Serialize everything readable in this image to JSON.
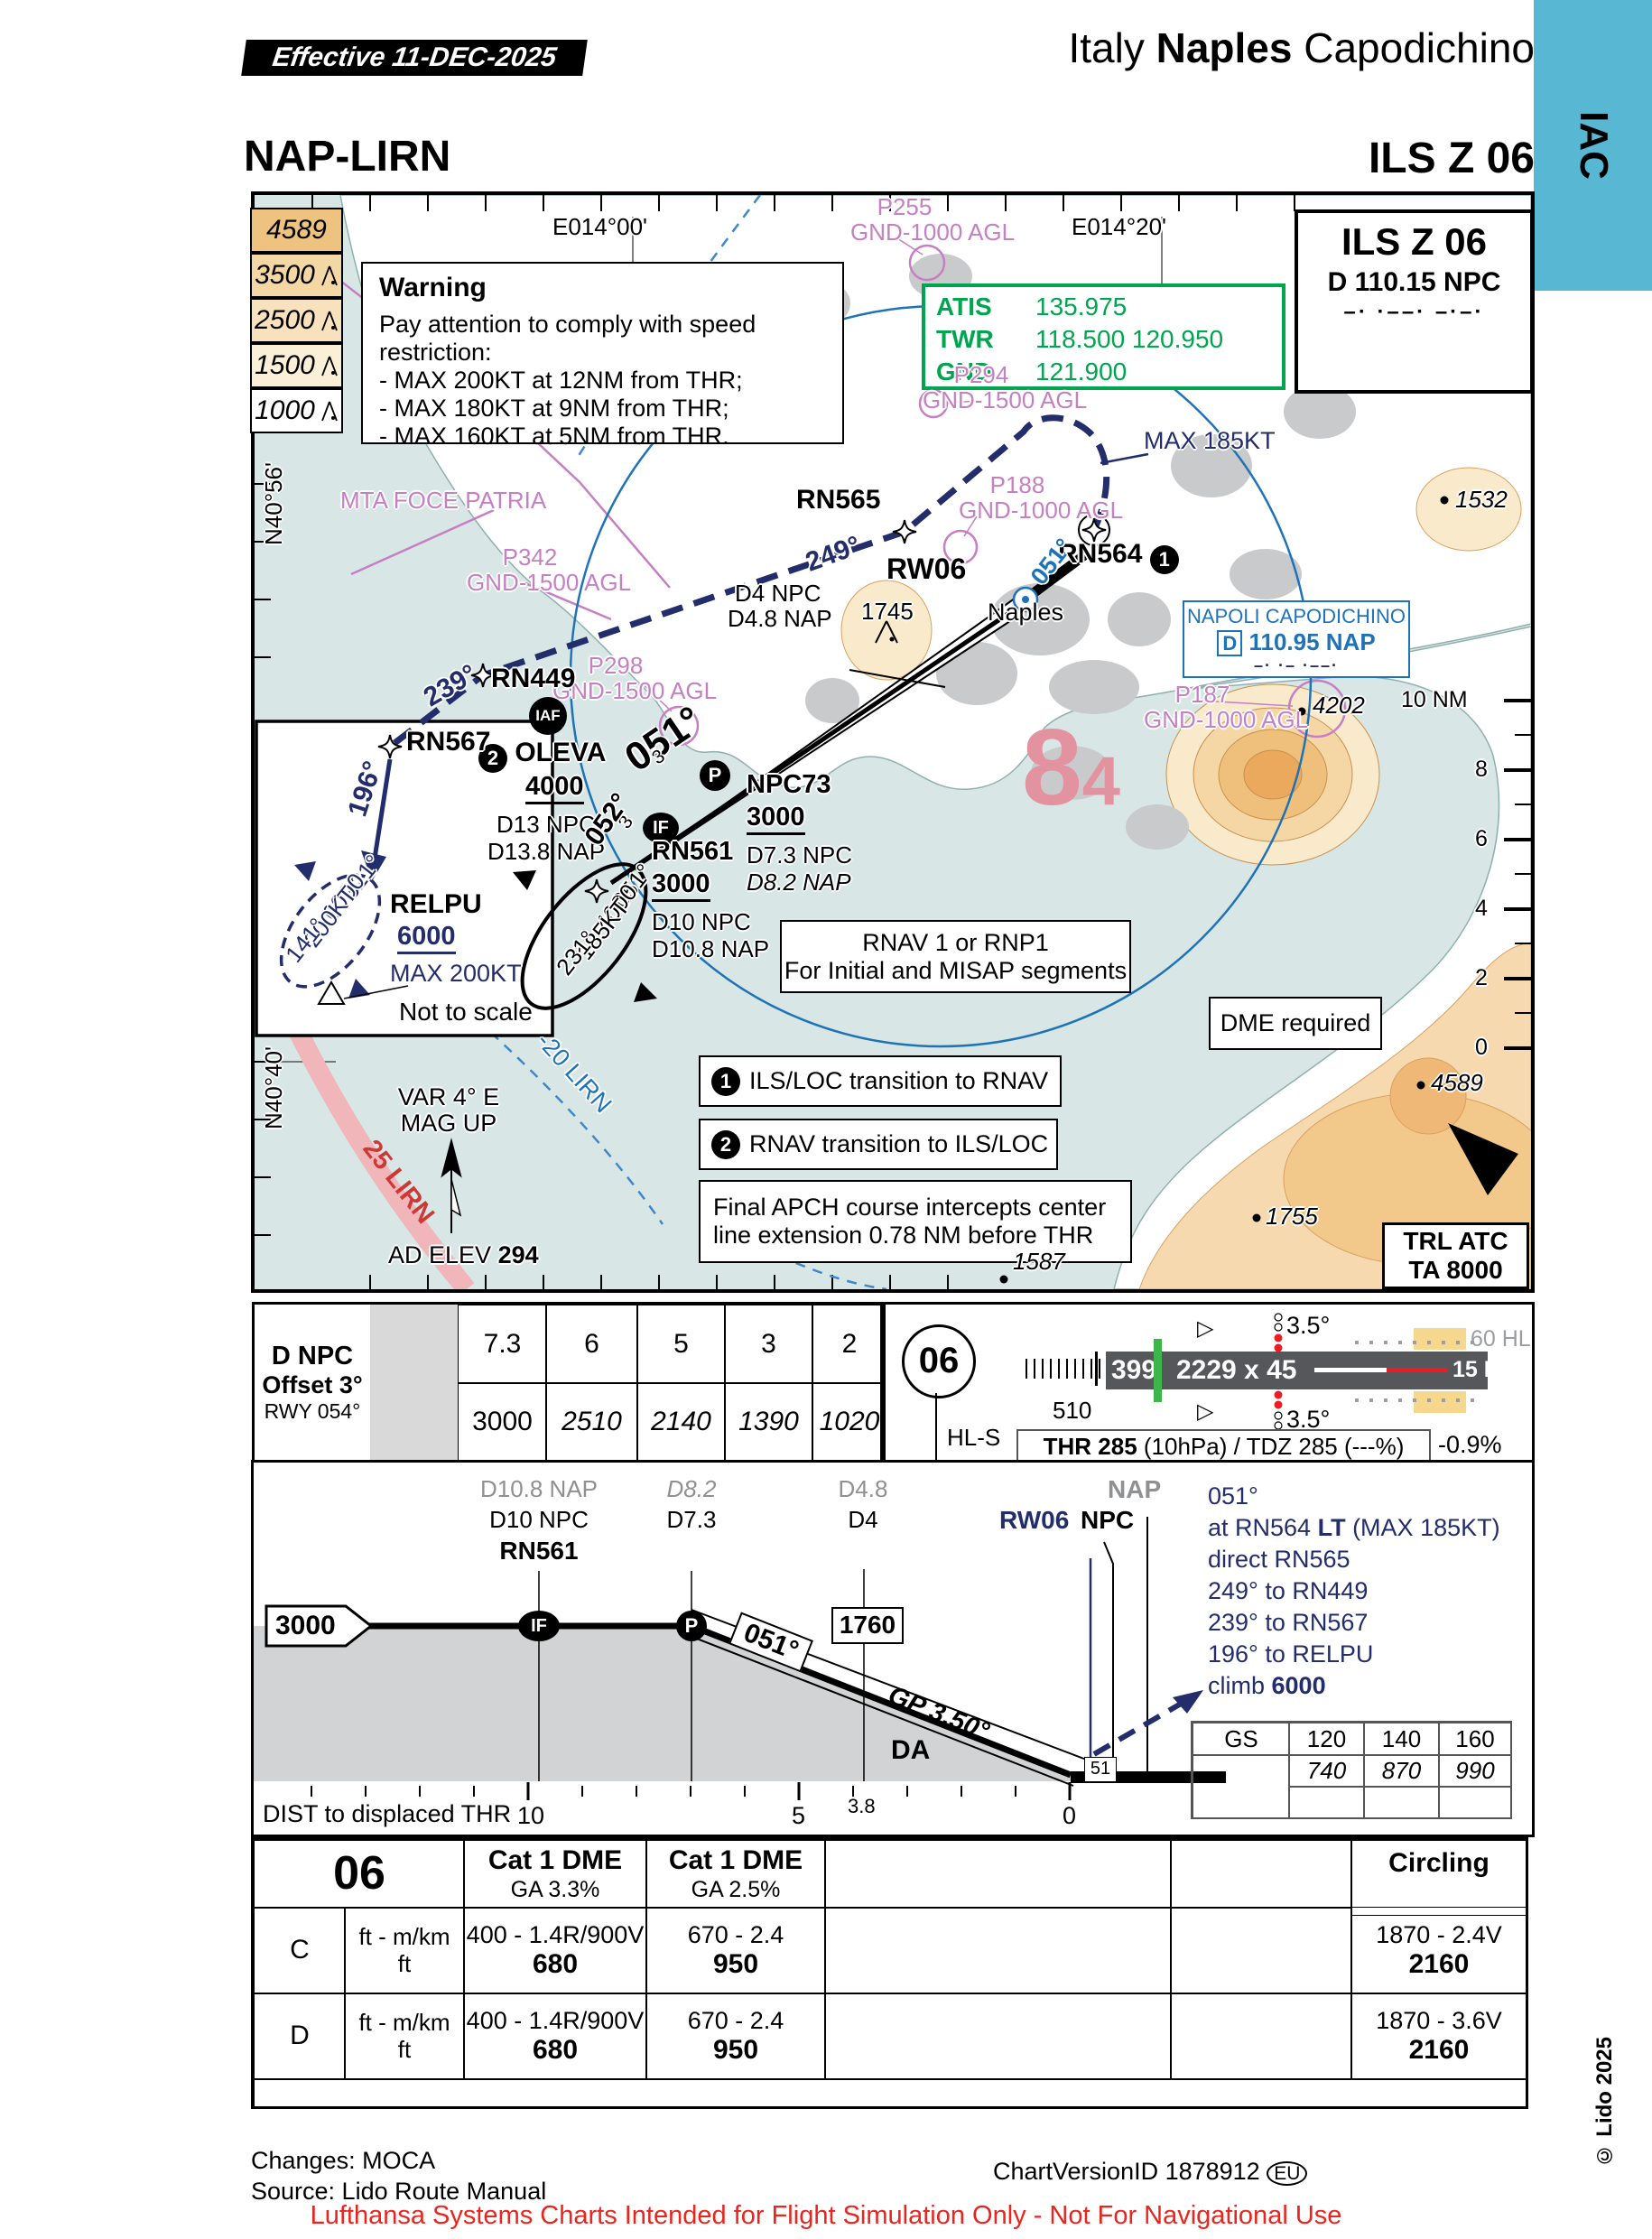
{
  "header": {
    "effective": "Effective  11-DEC-2025",
    "country": "Italy",
    "city": "Naples",
    "airport": "Capodichino",
    "tab": "IAC",
    "code": "NAP-LIRN",
    "proc": "ILS Z 06"
  },
  "ils_box": {
    "title": "ILS Z 06",
    "freq": "D 110.15 NPC",
    "morse": "–·  ·––·  –·–·"
  },
  "comms": {
    "atis_l": "ATIS",
    "atis_f": "135.975",
    "twr_l": "TWR",
    "twr_f": "118.500 120.950",
    "gnd_l": "GND",
    "gnd_f": "121.900"
  },
  "warning": {
    "title": "Warning",
    "intro": "Pay attention to comply with speed restriction:",
    "b1": "- MAX 200KT  at 12NM from THR;",
    "b2": "- MAX 180KT at 9NM from THR;",
    "b3": "- MAX 160KT at 5NM from THR."
  },
  "legend": {
    "a1": "4589",
    "a2": "3500",
    "a3": "2500",
    "a4": "1500",
    "a5": "1000"
  },
  "map": {
    "labels": {
      "e01400": "E014°00'",
      "e01420": "E014°20'",
      "p255": "P255",
      "p255g": "GND-1000 AGL",
      "p294": "P294",
      "p294g": "GND-1500 AGL",
      "mta": "MTA FOCE PATRIA",
      "p342": "P342",
      "p342g": "GND-1500 AGL",
      "rn565": "RN565",
      "c249": "249°",
      "max185": "MAX 185KT",
      "p188": "P188",
      "p188g": "GND-1000 AGL",
      "rn564": "RN564",
      "b1": "1",
      "c051blue": "051°",
      "rw06": "RW06",
      "naples": "Naples",
      "apt1": "NAPOLI CAPODICHINO",
      "aptd": "D",
      "aptf": "110.95 NAP",
      "aptm": "–· ·– ·––·",
      "e1532": "1532",
      "e1745": "1745",
      "d4npc": "D4 NPC",
      "d48nap": "D4.8 NAP",
      "p298": "P298",
      "p298g": "GND-1500 AGL",
      "p187": "P187",
      "p187g": "GND-1000 AGL",
      "e4202": "4202",
      "s10": "10 NM",
      "s8": "8",
      "s6": "6",
      "s4": "4",
      "s2": "2",
      "s0": "0",
      "c239": "239°",
      "rn449": "RN449",
      "iaf": "IAF",
      "b2": "2",
      "oleva": "OLEVA",
      "oleva_alt": "4000",
      "d13npc": "D13 NPC",
      "d138nap": "D13.8 NAP",
      "c051": "051°",
      "n3a": "3",
      "n3b": "3",
      "pbadge": "P",
      "ifbadge": "IF",
      "c052": "052°",
      "rn561": "RN561",
      "rn561alt": "3000",
      "d10npc": "D10 NPC",
      "d108nap": "D10.8 NAP",
      "npc73": "NPC73",
      "npc73alt": "3000",
      "d73npc": "D7.3 NPC",
      "d82nap": "D8.2 NAP",
      "h051": "051°",
      "h4000": "4000",
      "h185": "185KT",
      "h231": "231°",
      "big8": "8",
      "big4": "4",
      "rnav1": "RNAV 1 or RNP1",
      "rnav2": "For Initial and MISAP segments",
      "dmereq": "DME required",
      "e4589": "4589",
      "note1": "ILS/LOC transition to RNAV",
      "note2": "RNAV transition to ILS/LOC",
      "note3a": "Final APCH course intercepts center",
      "note3b": "line extension 0.78 NM before THR",
      "var1": "VAR 4° E",
      "var2": "MAG UP",
      "lirn25": "25 LIRN",
      "lirn20": "-20 LIRN",
      "adelev": "AD ELEV",
      "adelevv": "294",
      "e1755": "1755",
      "e1587": "1587",
      "trl1": "TRL ATC",
      "trl2": "TA 8000",
      "n4056": "N40°56'",
      "n4040": "N40°40'",
      "rn567": "RN567",
      "c196": "196°",
      "relpu": "RELPU",
      "relpualt": "6000",
      "relpumax": "MAX 200KT",
      "nts": "Not to scale",
      "i321": "321°",
      "i6000": "6000",
      "i200": "200KT",
      "i141": "141°"
    }
  },
  "dme_table": {
    "h1": "D NPC",
    "h2": "Offset 3°",
    "h3": "RWY 054°",
    "d": [
      "7.3",
      "6",
      "5",
      "3",
      "2"
    ],
    "a": [
      "3000",
      "2510",
      "2140",
      "1390",
      "1020"
    ]
  },
  "runway": {
    "id": "06",
    "disp": "510",
    "num": "399",
    "dims": "2229 x 45",
    "hl15": "15 HL",
    "hl60": "60 HL",
    "papi_t": "3.5°",
    "papi_b": "3.5°",
    "hls": "HL-S",
    "thr_b": "THR 285",
    "thr_r": "(10hPa) / TDZ 285 (---%)",
    "slope": "-0.9%"
  },
  "profile": {
    "d108": "D10.8 NAP",
    "d10": "D10 NPC",
    "rn561": "RN561",
    "d82": "D8.2",
    "d73": "D7.3",
    "d48": "D4.8",
    "d4": "D4",
    "nap": "NAP",
    "rw06": "RW06",
    "npc": "NPC",
    "alt": "3000",
    "if": "IF",
    "p": "P",
    "crs": "051°",
    "cross": "1760",
    "gp": "GP 3.50°",
    "da": "DA",
    "tch": "51",
    "m1": "051°",
    "m2a": "at RN564 ",
    "m2b": "LT",
    "m2c": " (MAX 185KT)",
    "m3": "direct RN565",
    "m4": "249° to RN449",
    "m5": "239° to RN567",
    "m6": "196° to RELPU",
    "m7a": "climb ",
    "m7b": "6000",
    "gs": "GS",
    "gs1": "120",
    "gs2": "140",
    "gs3": "160",
    "t1": "740",
    "t2": "870",
    "t3": "990",
    "dist": "DIST to displaced THR",
    "x10": "10",
    "x5": "5",
    "x38": "3.8",
    "x0": "0"
  },
  "minimums": {
    "rwy": "06",
    "c1": "Cat 1 DME",
    "g1": "GA 3.3%",
    "c2": "Cat 1 DME",
    "g2": "GA 2.5%",
    "circ": "Circling",
    "rows": [
      {
        "cat": "C",
        "u1": "ft - m/km",
        "u2": "ft",
        "a1": "400 - 1.4R/900V",
        "a2": "680",
        "b1": "670 - 2.4",
        "b2": "950",
        "cc1": "1870 - 2.4V",
        "cc2": "2160"
      },
      {
        "cat": "D",
        "u1": "ft - m/km",
        "u2": "ft",
        "a1": "400 - 1.4R/900V",
        "a2": "680",
        "b1": "670 - 2.4",
        "b2": "950",
        "cc1": "1870 - 3.6V",
        "cc2": "2160"
      }
    ]
  },
  "footer": {
    "changes": "Changes: MOCA",
    "source": "Source: Lido Route Manual",
    "version": "ChartVersionID 1878912",
    "eu": "EU",
    "copyright": "© Lido 2025",
    "disclaimer": "Lufthansa Systems Charts Intended for Flight Simulation Only - Not For Navigational Use"
  }
}
